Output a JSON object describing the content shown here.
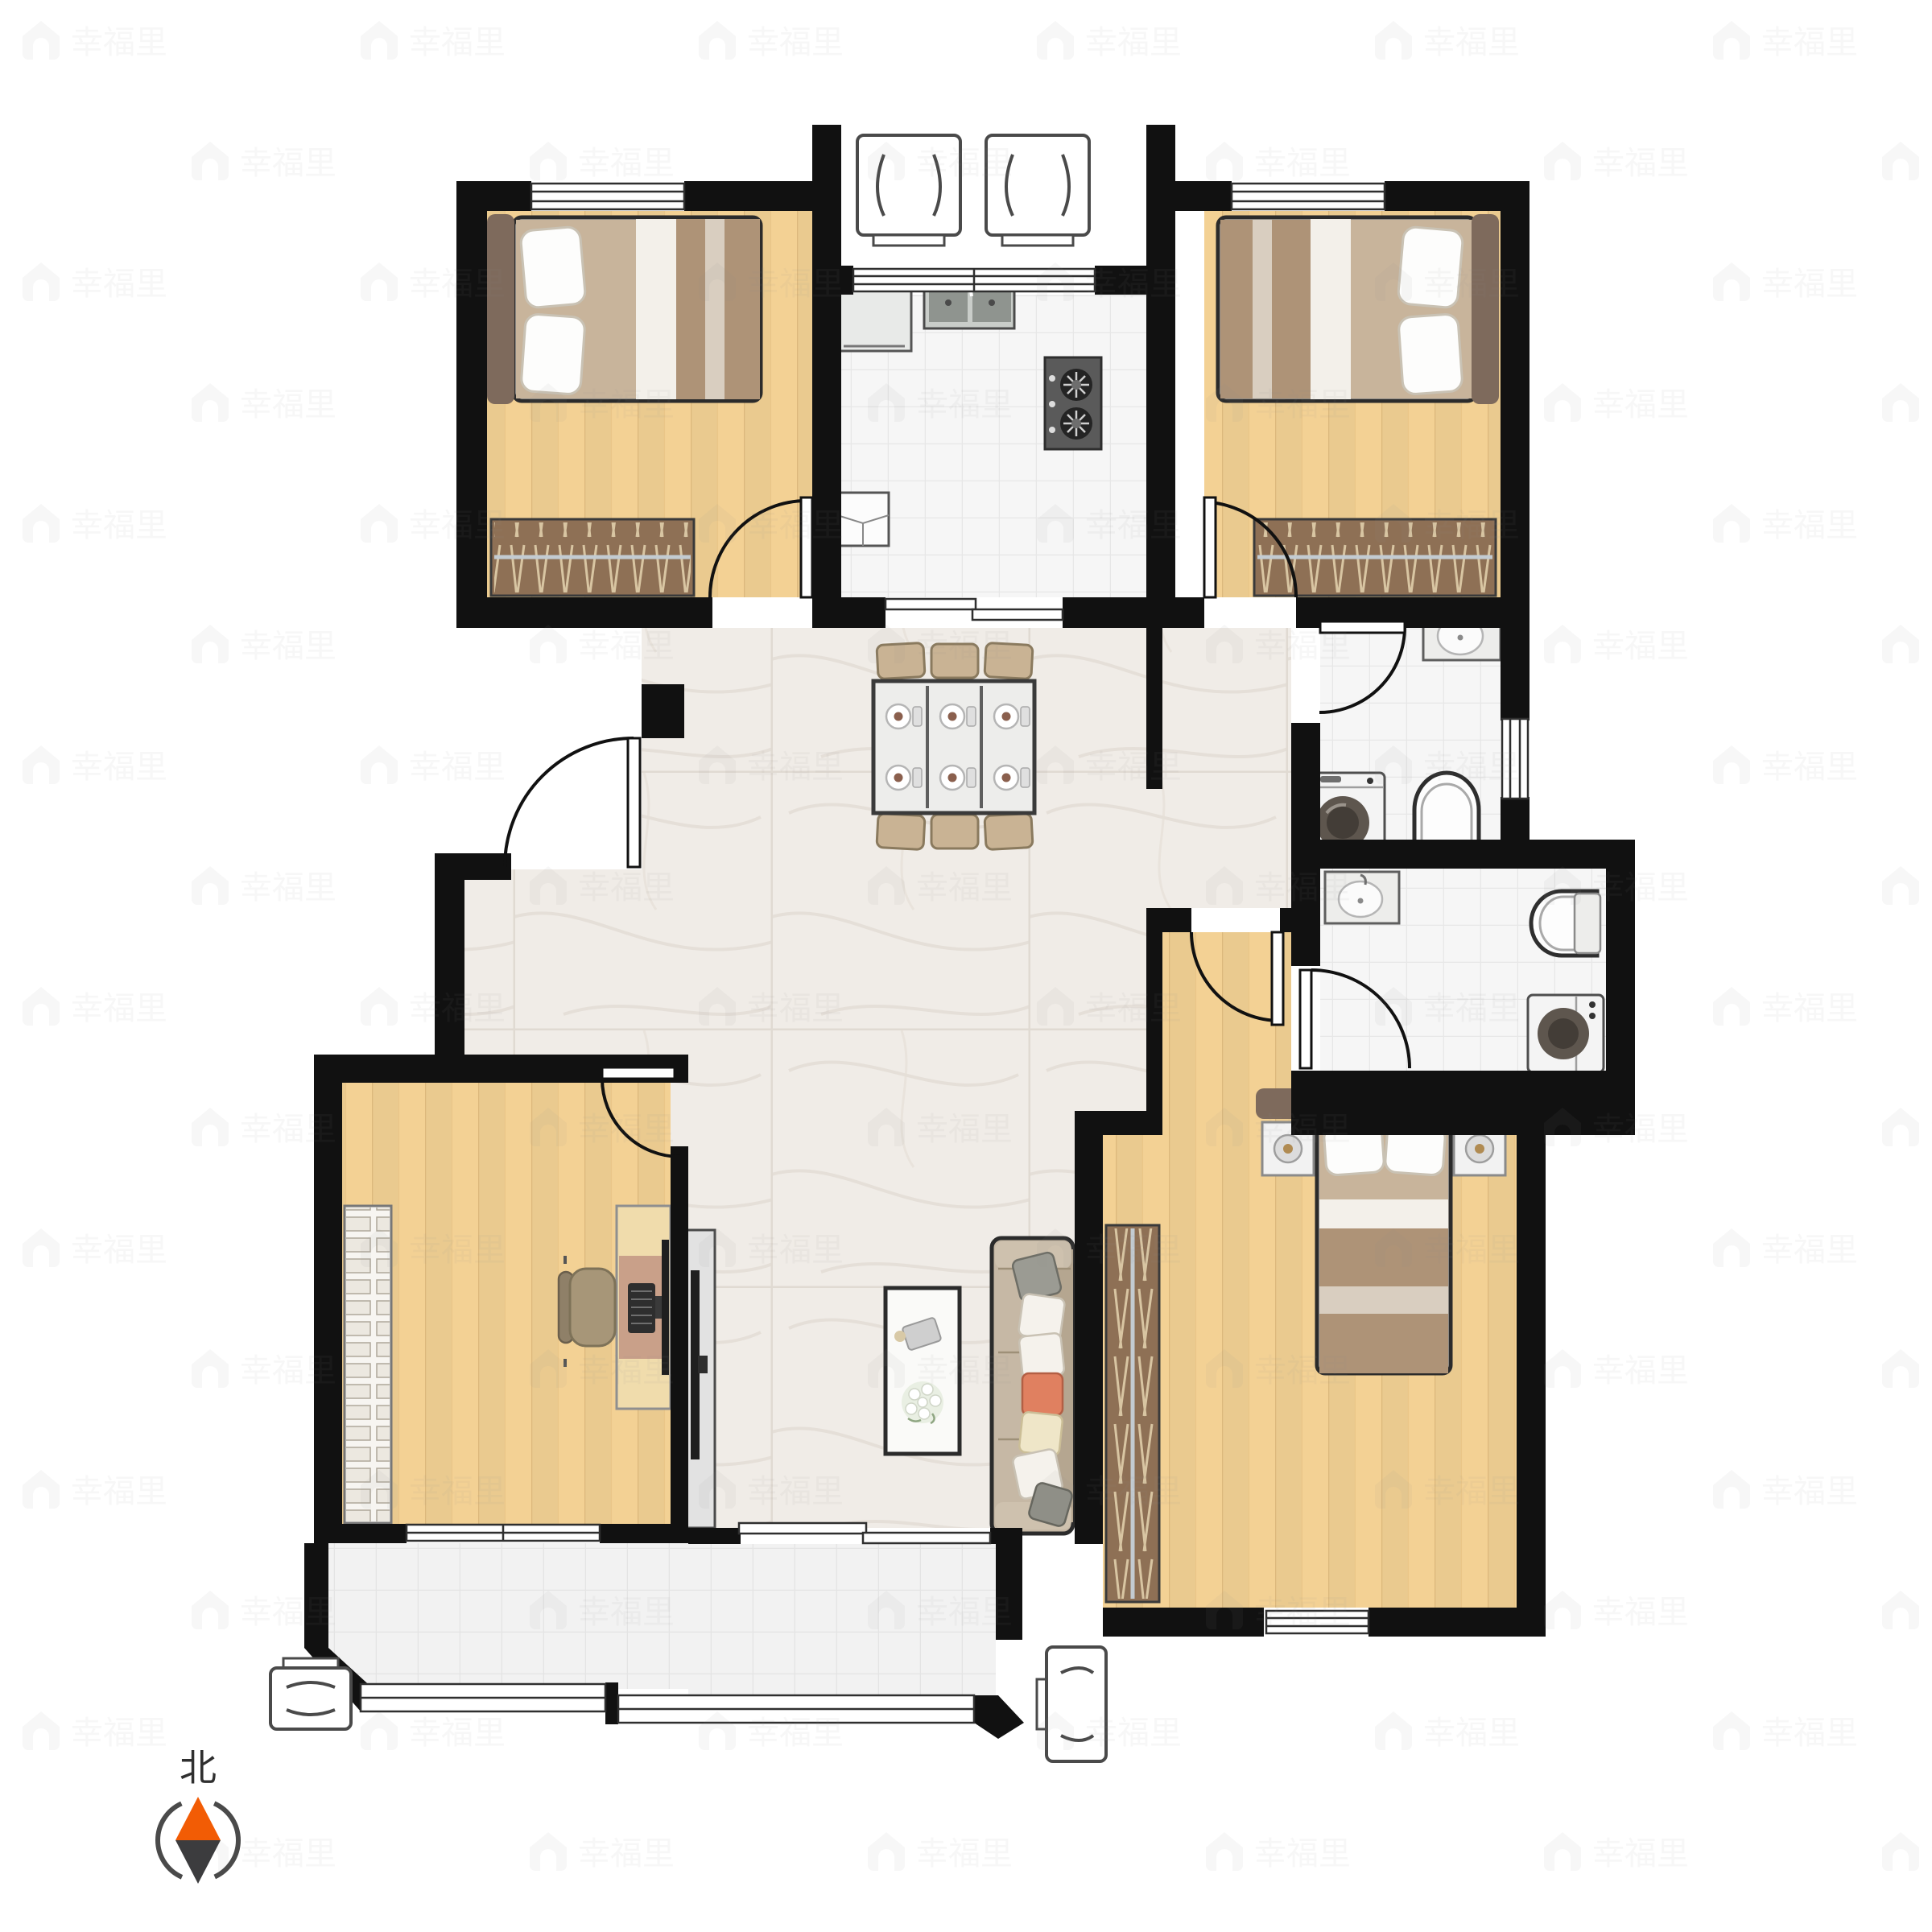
{
  "watermark": {
    "text": "幸福里",
    "icon": "house-icon",
    "color": "#8A8A8A",
    "opacity": "0.07"
  },
  "compass": {
    "label": "北",
    "north_color": "#F25C05",
    "south_color": "#3C3C3E",
    "ring_color": "#4A4A4A",
    "label_color": "#2F2F2F"
  },
  "palette": {
    "wall": "#111111",
    "wood_floor": "#F3D194",
    "wood_plank_line": "#C89D5F",
    "marble_floor": "#F0ECE7",
    "tile_floor": "#F6F6F6",
    "balcony_floor": "#F2F2F2",
    "wardrobe": "#8E7055",
    "wardrobe_hanger": "#D8C5A2",
    "headboard": "#7E6A5C",
    "blanket": "#AE9377",
    "pillow": "#FDFDFC",
    "sofa": "#C6B8A5",
    "accent_pillow": "#E08060",
    "cream_pillow": "#EFE6C8",
    "appliance": "#EFEFEF",
    "drum_dark": "#5E564E",
    "stove_panel": "#5A5A5A",
    "desk_wood": "#F0DCAC",
    "desk_pad": "#C9A089",
    "tv_dark": "#1F1F1F",
    "chair_tan": "#C9B394"
  },
  "rooms": [
    {
      "name": "bedroom-top-left",
      "floor": "wood"
    },
    {
      "name": "kitchen",
      "floor": "tile"
    },
    {
      "name": "bedroom-top-right",
      "floor": "wood"
    },
    {
      "name": "bathroom-upper",
      "floor": "tile"
    },
    {
      "name": "bathroom-lower",
      "floor": "tile"
    },
    {
      "name": "living-dining-room",
      "floor": "marble"
    },
    {
      "name": "study",
      "floor": "wood"
    },
    {
      "name": "master-bedroom",
      "floor": "wood"
    },
    {
      "name": "balcony",
      "floor": "tile"
    },
    {
      "name": "entry-recess",
      "floor": "none"
    }
  ],
  "furniture": [
    {
      "name": "double-bed",
      "count": 3
    },
    {
      "name": "wardrobe",
      "count": 3
    },
    {
      "name": "nightstand-with-lamp",
      "count": 2
    },
    {
      "name": "dining-table",
      "count": 1,
      "seats": 6
    },
    {
      "name": "dining-chair",
      "count": 6
    },
    {
      "name": "sofa",
      "count": 1
    },
    {
      "name": "coffee-table-with-flowers",
      "count": 1
    },
    {
      "name": "tv-cabinet",
      "count": 1
    },
    {
      "name": "desk-with-computer",
      "count": 1
    },
    {
      "name": "office-chair",
      "count": 1
    },
    {
      "name": "bookshelf",
      "count": 1
    },
    {
      "name": "kitchen-sink",
      "count": 1
    },
    {
      "name": "gas-stove",
      "count": 1
    },
    {
      "name": "refrigerator-counter",
      "count": 1
    },
    {
      "name": "wash-basin",
      "count": 2
    },
    {
      "name": "toilet",
      "count": 2
    },
    {
      "name": "washing-machine",
      "count": 2
    },
    {
      "name": "air-conditioner-outdoor-unit",
      "count": 4
    },
    {
      "name": "swing-door",
      "count": 7
    },
    {
      "name": "sliding-door",
      "count": 2
    }
  ]
}
